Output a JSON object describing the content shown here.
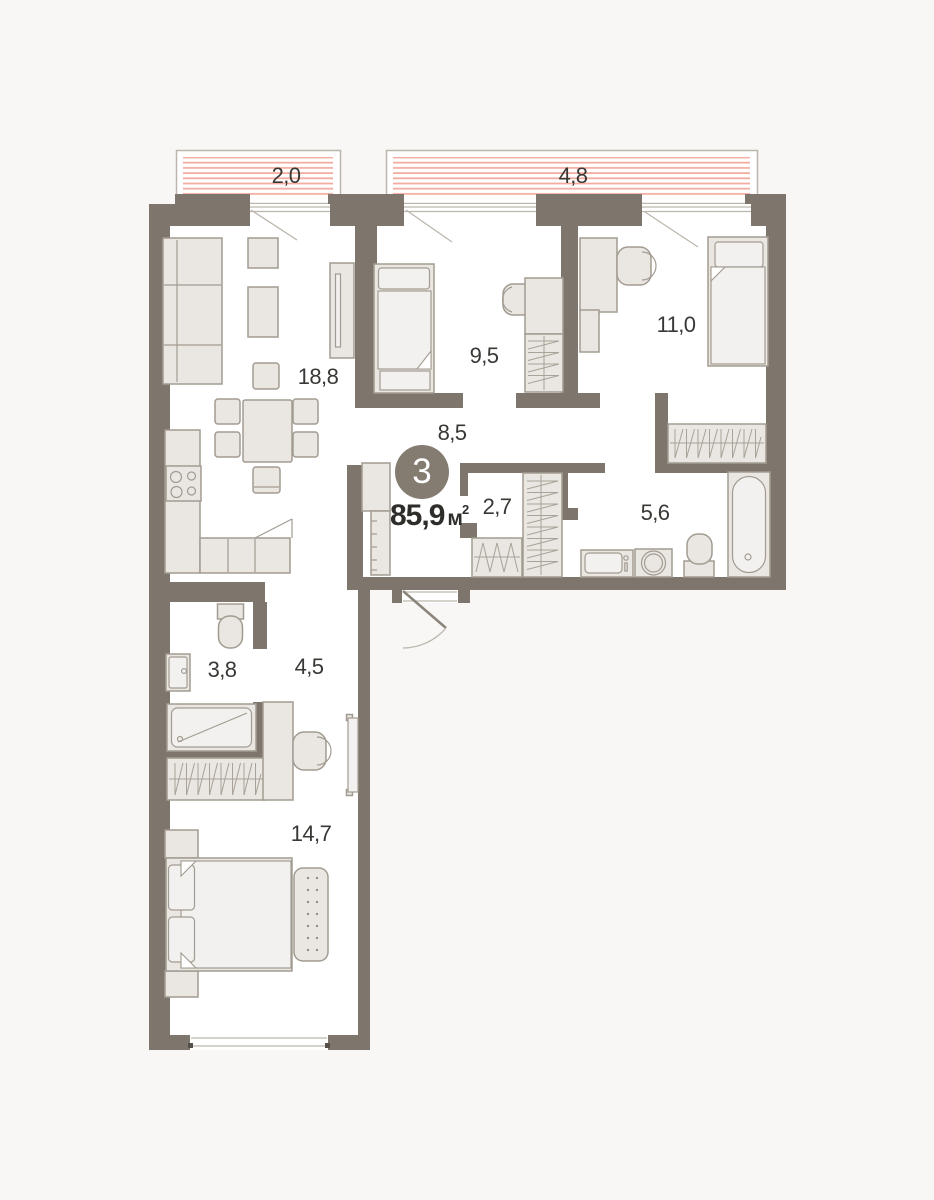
{
  "plan": {
    "badge": {
      "number": "3"
    },
    "area": {
      "value": "85,9",
      "unit": "м",
      "sup": "2"
    },
    "balconies": [
      {
        "id": "balcony-left",
        "label": "2,0"
      },
      {
        "id": "balcony-right",
        "label": "4,8"
      }
    ],
    "rooms": [
      {
        "id": "living-kitchen",
        "label": "18,8"
      },
      {
        "id": "bedroom-2",
        "label": "9,5"
      },
      {
        "id": "bedroom-3",
        "label": "11,0"
      },
      {
        "id": "hallway",
        "label": "8,5"
      },
      {
        "id": "wardrobe-closet",
        "label": "2,7"
      },
      {
        "id": "bathroom",
        "label": "5,6"
      },
      {
        "id": "wc",
        "label": "3,8"
      },
      {
        "id": "corridor",
        "label": "4,5"
      },
      {
        "id": "master-bedroom",
        "label": "14,7"
      }
    ],
    "colors": {
      "wall": "#7e766c",
      "furniture_fill": "#eae6e1",
      "furniture_outline": "#a29b91",
      "balcony_stripe": "#f3aca0",
      "badge_background": "#847b71",
      "text": "#3a3835",
      "background": "#f8f7f5",
      "floor": "#ffffff"
    }
  }
}
